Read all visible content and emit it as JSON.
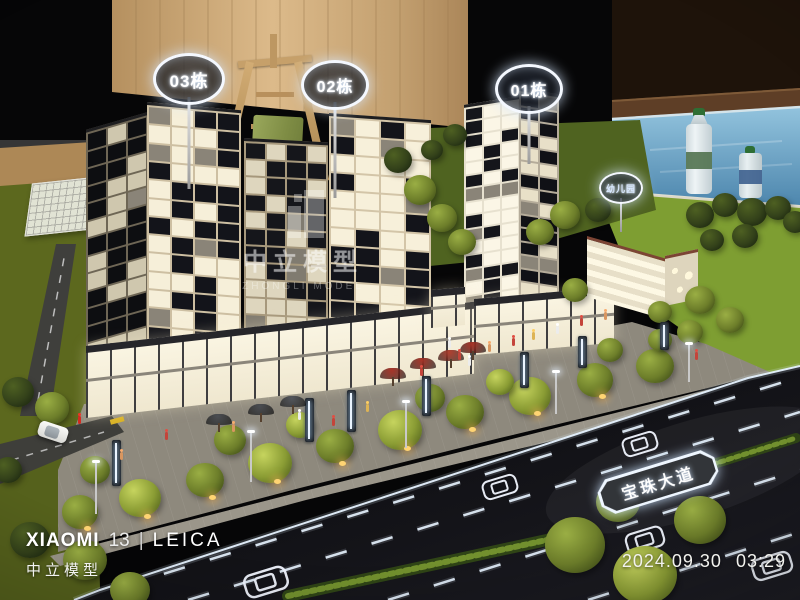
{
  "photo": {
    "kind": "architectural-scale-model-photograph",
    "building_signs": [
      {
        "label": "03栋"
      },
      {
        "label": "02栋"
      },
      {
        "label": "01栋"
      }
    ],
    "facility_sign": {
      "label": "幼儿园"
    },
    "road_sign": {
      "label": "宝珠大道"
    }
  },
  "watermarks": {
    "center": {
      "cn": "中立模型",
      "en": "ZHONGLI MODEL"
    },
    "camera": {
      "brand": "XIAOMI",
      "model": "13",
      "divider": "|",
      "lens": "LEICA",
      "studio": "中立模型"
    },
    "timestamp": {
      "date": "2024.09.30",
      "time": "03:29"
    }
  },
  "colors": {
    "lit_window": "#f6efda",
    "glow_marking": "#e4f0fc",
    "water": "#6fa9cc",
    "lawn_bright": "#7e9e32",
    "lawn_dark": "#5c681e",
    "wood_wall": "#c9a97c",
    "red_umbrella": "#a83428"
  }
}
